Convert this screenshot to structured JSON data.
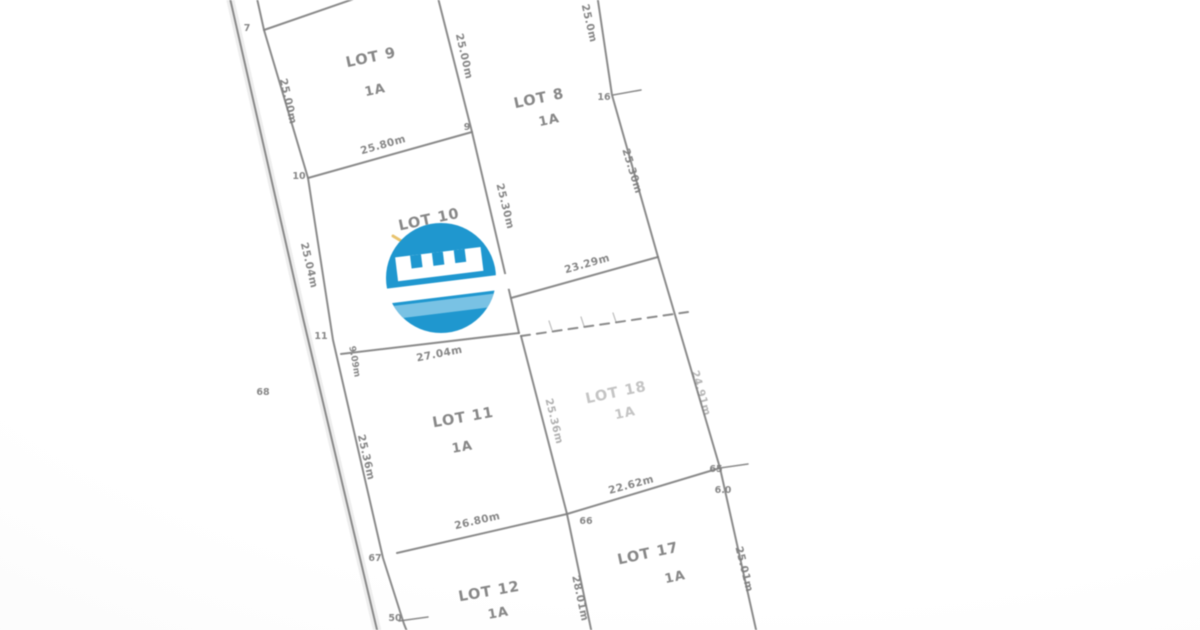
{
  "document": {
    "type": "cadastral-survey-plat",
    "area_code": "1A"
  },
  "logo": {
    "name": "watermark-logo",
    "color": "#1699d6",
    "light_stripe": "#74c3e8",
    "white": "#ffffff"
  },
  "plat": {
    "line_color": "#7e7e7e",
    "text_color": "#7d7d7d",
    "lots_visible": [
      "LOT 8",
      "LOT 9",
      "LOT 10",
      "LOT 11",
      "LOT 12",
      "LOT 17",
      "LOT 18"
    ],
    "labels": [
      {
        "t": "LOT 9",
        "x": 372,
        "y": 62,
        "r": -12,
        "k": "lot"
      },
      {
        "t": "1A",
        "x": 376,
        "y": 94,
        "r": -12,
        "k": "area"
      },
      {
        "t": "LOT 8",
        "x": 540,
        "y": 103,
        "r": -12,
        "k": "lot"
      },
      {
        "t": "1A",
        "x": 550,
        "y": 124,
        "r": -12,
        "k": "area"
      },
      {
        "t": "LOT 10",
        "x": 430,
        "y": 224,
        "r": -12,
        "k": "lot"
      },
      {
        "t": "LOT 11",
        "x": 464,
        "y": 422,
        "r": -10,
        "k": "lot"
      },
      {
        "t": "1A",
        "x": 463,
        "y": 451,
        "r": -10,
        "k": "area"
      },
      {
        "t": "LOT 18",
        "x": 617,
        "y": 397,
        "r": -12,
        "k": "lot",
        "o": 0.45
      },
      {
        "t": "1A",
        "x": 626,
        "y": 417,
        "r": -12,
        "k": "area",
        "o": 0.45
      },
      {
        "t": "LOT 12",
        "x": 490,
        "y": 596,
        "r": -10,
        "k": "lot"
      },
      {
        "t": "1A",
        "x": 499,
        "y": 617,
        "r": -10,
        "k": "area"
      },
      {
        "t": "LOT 17",
        "x": 649,
        "y": 558,
        "r": -12,
        "k": "lot"
      },
      {
        "t": "1A",
        "x": 676,
        "y": 581,
        "r": -12,
        "k": "area"
      },
      {
        "t": "25.00m",
        "x": 285,
        "y": 102,
        "r": 77,
        "k": "measure"
      },
      {
        "t": "25.04m",
        "x": 306,
        "y": 266,
        "r": 77,
        "k": "measure"
      },
      {
        "t": "25.36m",
        "x": 363,
        "y": 458,
        "r": 77,
        "k": "measure"
      },
      {
        "t": "9.09m",
        "x": 352,
        "y": 362,
        "r": 80,
        "k": "small"
      },
      {
        "t": "25.80m",
        "x": 384,
        "y": 148,
        "r": -16,
        "k": "measure"
      },
      {
        "t": "25.00m",
        "x": 461,
        "y": 57,
        "r": 77,
        "k": "measure"
      },
      {
        "t": "25.30m",
        "x": 502,
        "y": 207,
        "r": 76,
        "k": "measure"
      },
      {
        "t": "25.0m",
        "x": 586,
        "y": 24,
        "r": 77,
        "k": "measure"
      },
      {
        "t": "25.30m",
        "x": 629,
        "y": 172,
        "r": 73,
        "k": "measure"
      },
      {
        "t": "23.29m",
        "x": 588,
        "y": 267,
        "r": -16,
        "k": "measure"
      },
      {
        "t": "27.04m",
        "x": 440,
        "y": 357,
        "r": -11,
        "k": "measure"
      },
      {
        "t": "24.91m",
        "x": 698,
        "y": 394,
        "r": 74,
        "k": "measure",
        "o": 0.55
      },
      {
        "t": "25.36m",
        "x": 551,
        "y": 422,
        "r": 76,
        "k": "measure",
        "o": 0.6
      },
      {
        "t": "26.80m",
        "x": 478,
        "y": 524,
        "r": -13,
        "k": "measure"
      },
      {
        "t": "22.62m",
        "x": 632,
        "y": 488,
        "r": -15,
        "k": "measure"
      },
      {
        "t": "28.01m",
        "x": 577,
        "y": 599,
        "r": 78,
        "k": "measure"
      },
      {
        "t": "25.01m",
        "x": 741,
        "y": 570,
        "r": 76,
        "k": "measure"
      },
      {
        "t": "7",
        "x": 247,
        "y": 31,
        "k": "vertex"
      },
      {
        "t": "10",
        "x": 299,
        "y": 179,
        "k": "vertex"
      },
      {
        "t": "9",
        "x": 467,
        "y": 130,
        "k": "vertex"
      },
      {
        "t": "16",
        "x": 604,
        "y": 100,
        "k": "vertex"
      },
      {
        "t": "11",
        "x": 321,
        "y": 339,
        "k": "vertex"
      },
      {
        "t": "68",
        "x": 263,
        "y": 395,
        "k": "vertex"
      },
      {
        "t": "67",
        "x": 375,
        "y": 561,
        "k": "vertex"
      },
      {
        "t": "50",
        "x": 395,
        "y": 621,
        "k": "vertex"
      },
      {
        "t": "66",
        "x": 586,
        "y": 524,
        "k": "vertex"
      },
      {
        "t": "65",
        "x": 716,
        "y": 472,
        "k": "vertex"
      },
      {
        "t": "6.0",
        "x": 723,
        "y": 493,
        "k": "vertex"
      }
    ],
    "lines": [
      {
        "p": [
          [
            229,
            -6
          ],
          [
            303,
            318
          ],
          [
            378,
            634
          ]
        ],
        "w": 8,
        "c": "#e6e6e6",
        "o": 0.7
      },
      {
        "p": [
          [
            229,
            -6
          ],
          [
            303,
            318
          ],
          [
            378,
            634
          ]
        ]
      },
      {
        "p": [
          [
            256,
            -6
          ],
          [
            264,
            30
          ],
          [
            308,
            178
          ],
          [
            333,
            340
          ],
          [
            383,
            558
          ],
          [
            404,
            624
          ],
          [
            408,
            634
          ]
        ]
      },
      {
        "p": [
          [
            264,
            30
          ],
          [
            368,
            -6
          ]
        ]
      },
      {
        "p": [
          [
            437,
            -6
          ],
          [
            472,
            132
          ],
          [
            519,
            333
          ]
        ]
      },
      {
        "p": [
          [
            308,
            178
          ],
          [
            472,
            132
          ]
        ]
      },
      {
        "p": [
          [
            341,
            354
          ],
          [
            519,
            333
          ]
        ]
      },
      {
        "p": [
          [
            597,
            -6
          ],
          [
            612,
            95
          ],
          [
            658,
            257
          ]
        ]
      },
      {
        "p": [
          [
            511,
            298
          ],
          [
            658,
            257
          ]
        ]
      },
      {
        "p": [
          [
            658,
            257
          ],
          [
            720,
            468
          ]
        ]
      },
      {
        "p": [
          [
            720,
            468
          ],
          [
            757,
            634
          ]
        ]
      },
      {
        "p": [
          [
            521,
            336
          ],
          [
            567,
            514
          ]
        ]
      },
      {
        "p": [
          [
            397,
            553
          ],
          [
            567,
            514
          ]
        ]
      },
      {
        "p": [
          [
            567,
            514
          ],
          [
            592,
            634
          ]
        ]
      },
      {
        "p": [
          [
            567,
            514
          ],
          [
            720,
            468
          ]
        ]
      },
      {
        "p": [
          [
            613,
            95
          ],
          [
            641,
            90
          ]
        ],
        "w": 1.5
      },
      {
        "p": [
          [
            720,
            468
          ],
          [
            748,
            464
          ]
        ],
        "w": 1.5
      },
      {
        "p": [
          [
            399,
            621
          ],
          [
            428,
            617
          ]
        ],
        "w": 1.5
      },
      {
        "p": [
          [
            521,
            336
          ],
          [
            688,
            312
          ]
        ],
        "dash": true
      },
      {
        "p": [
          [
            552,
            330
          ],
          [
            549,
            321
          ]
        ],
        "w": 1.2,
        "o": 0.5
      },
      {
        "p": [
          [
            584,
            326
          ],
          [
            581,
            317
          ]
        ],
        "w": 1.2,
        "o": 0.5
      },
      {
        "p": [
          [
            616,
            322
          ],
          [
            613,
            313
          ]
        ],
        "w": 1.2,
        "o": 0.5
      },
      {
        "p": [
          [
            393,
            236
          ],
          [
            403,
            242
          ]
        ],
        "w": 3,
        "c": "#e8b84b",
        "o": 0.85
      }
    ]
  }
}
